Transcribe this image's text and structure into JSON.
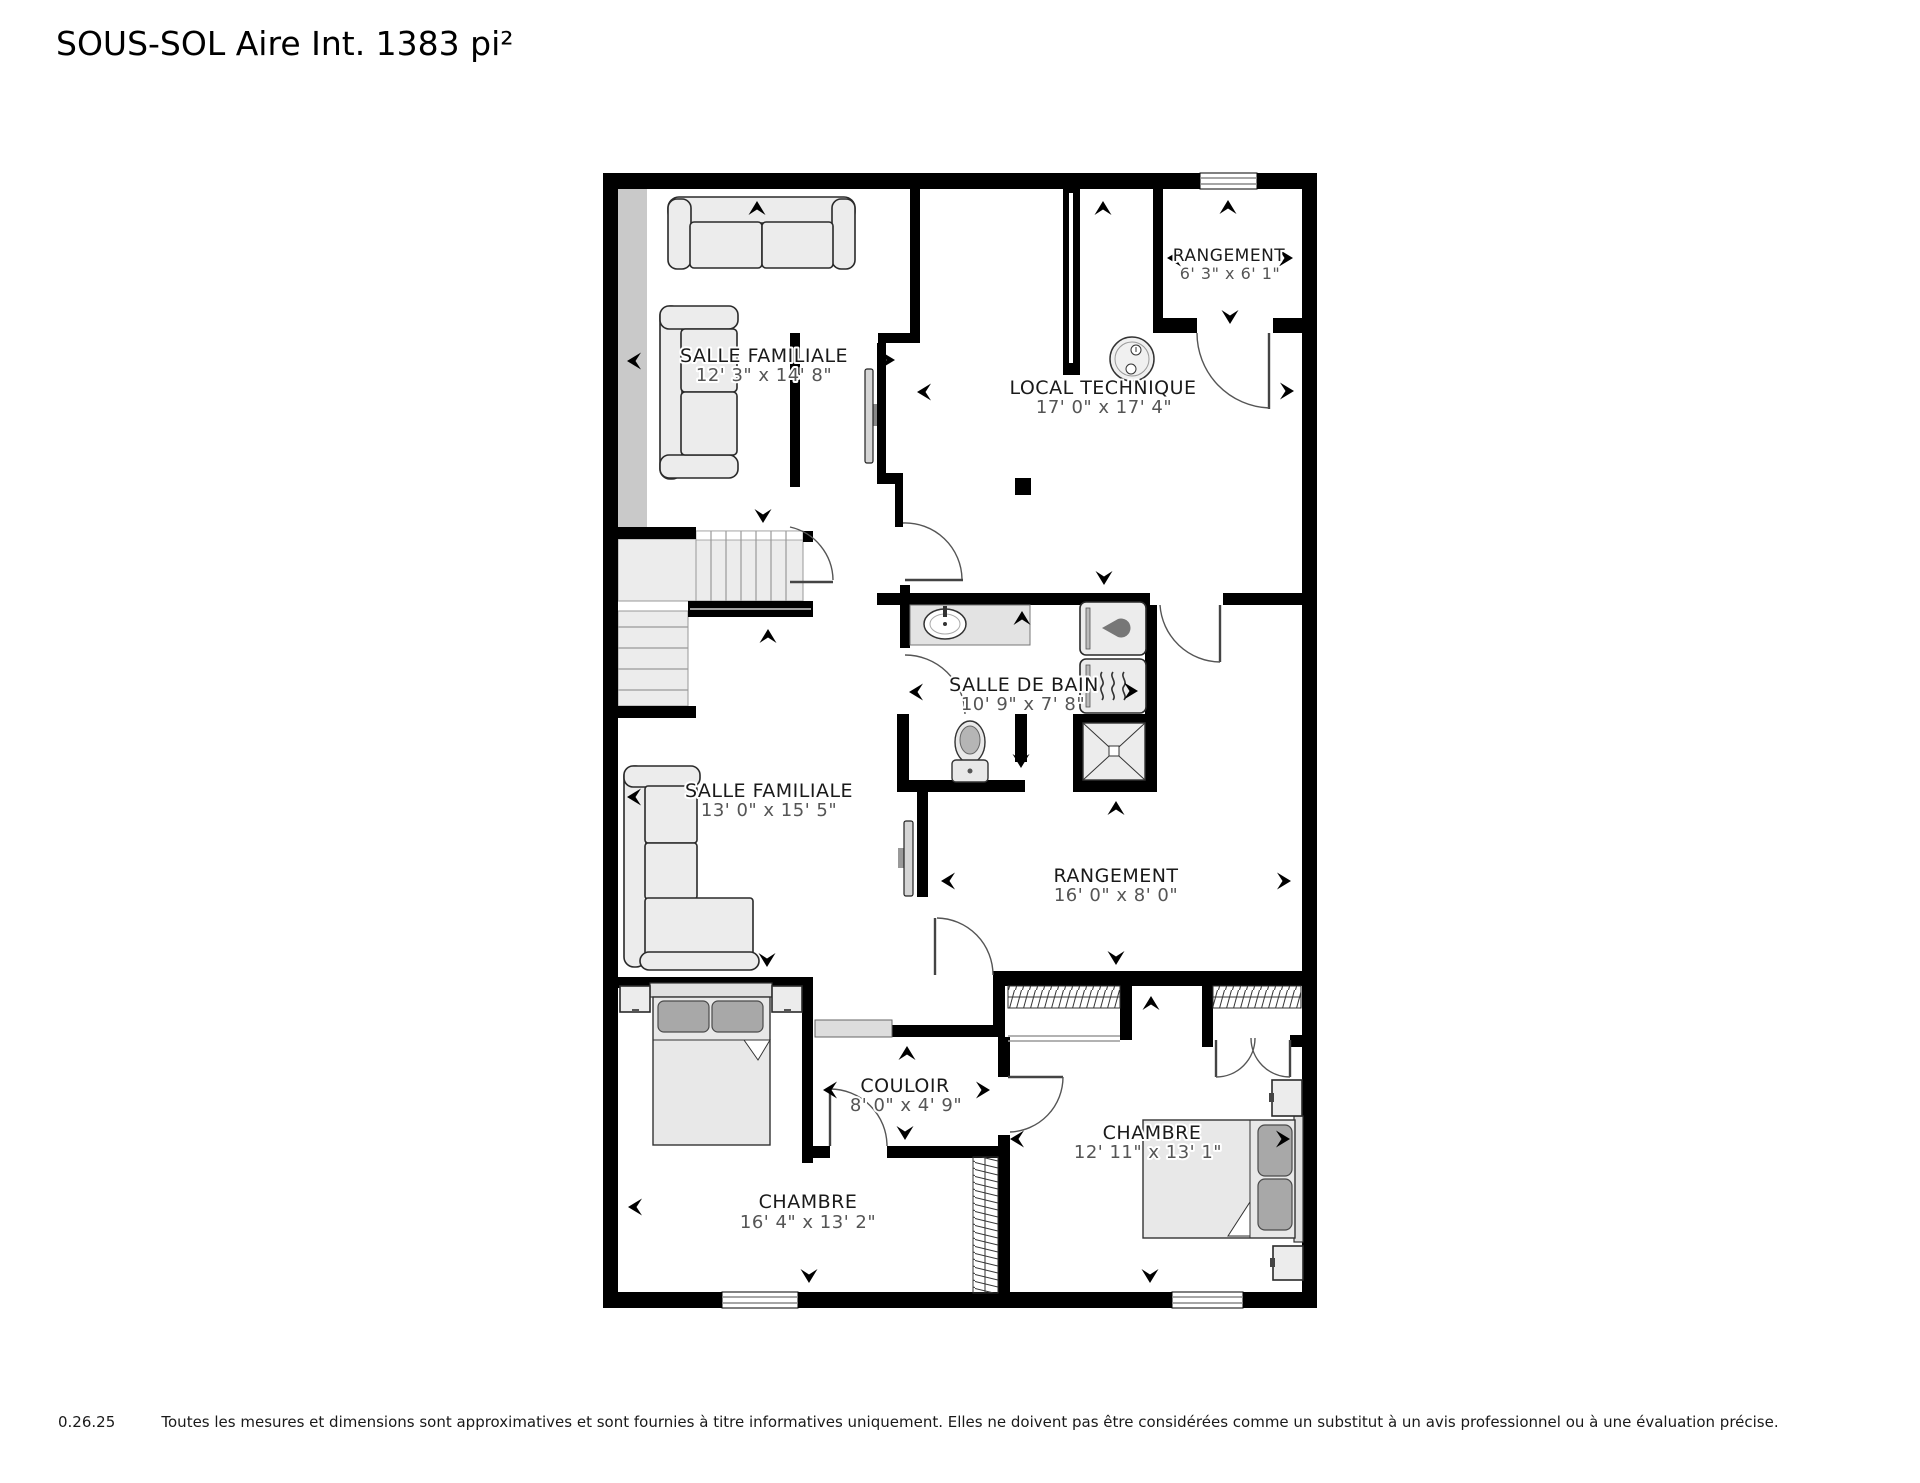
{
  "title": "SOUS-SOL Aire Int. 1383 pi²",
  "floorplan": {
    "rooms": [
      {
        "id": "salle-familiale-haut",
        "name": "SALLE FAMILIALE",
        "dims": "12' 3\" x 14' 8\""
      },
      {
        "id": "local-technique",
        "name": "LOCAL TECHNIQUE",
        "dims": "17' 0\" x 17' 4\""
      },
      {
        "id": "rangement-petit",
        "name": "RANGEMENT",
        "dims": "6' 3\" x 6' 1\""
      },
      {
        "id": "salle-de-bain",
        "name": "SALLE DE BAIN",
        "dims": "10' 9\" x 7' 8\""
      },
      {
        "id": "salle-familiale-bas",
        "name": "SALLE FAMILIALE",
        "dims": "13' 0\" x 15' 5\""
      },
      {
        "id": "rangement-grand",
        "name": "RANGEMENT",
        "dims": "16' 0\" x 8' 0\""
      },
      {
        "id": "couloir",
        "name": "COULOIR",
        "dims": "8' 0\" x 4' 9\""
      },
      {
        "id": "chambre-gauche",
        "name": "CHAMBRE",
        "dims": "16' 4\" x 13' 2\""
      },
      {
        "id": "chambre-droite",
        "name": "CHAMBRE",
        "dims": "12' 11\" x 13' 1\""
      }
    ],
    "icons": [
      "dimension-arrow",
      "stairs",
      "door-swing",
      "window",
      "tv",
      "sofa",
      "bed",
      "nightstand",
      "dresser",
      "sink",
      "toilet",
      "shower",
      "washer",
      "dryer",
      "water-heater",
      "furnace",
      "closet-rod-hatch"
    ],
    "colors": {
      "wall": "#000000",
      "furniture_fill": "#ececec",
      "room_label": "#1a1a1a",
      "dims_label": "#555555",
      "stair_shade": "#c9c9c9"
    }
  },
  "footer": {
    "version": "0.26.25",
    "disclaimer": "Toutes les mesures et dimensions sont approximatives et sont fournies à titre informatives uniquement. Elles ne doivent pas être considérées comme un substitut à un avis professionnel ou à une évaluation précise."
  }
}
